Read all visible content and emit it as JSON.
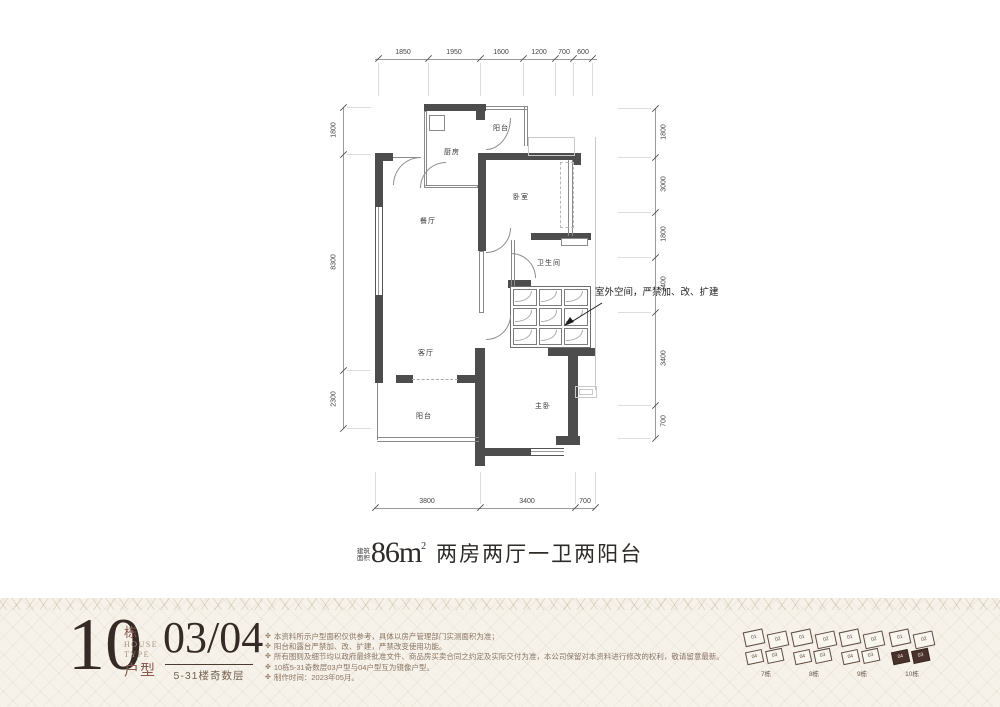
{
  "title": {
    "prefix_line1": "建筑",
    "prefix_line2": "面积",
    "area": "86m",
    "area_sup": "2",
    "desc": "两房两厅一卫两阳台"
  },
  "plan": {
    "rooms": [
      {
        "label": "厨房"
      },
      {
        "label": "阳台"
      },
      {
        "label": "卧室"
      },
      {
        "label": "餐厅"
      },
      {
        "label": "卫生间"
      },
      {
        "label": "客厅"
      },
      {
        "label": "阳台"
      },
      {
        "label": "主卧"
      }
    ],
    "annotation": "室外空间，严禁加、改、扩建",
    "dims": {
      "top": [
        "1850",
        "1950",
        "1600",
        "1200",
        "700",
        "600"
      ],
      "left": [
        "1800",
        "8300",
        "2300"
      ],
      "right": [
        "1800",
        "3000",
        "1800",
        "2400",
        "3400",
        "700"
      ],
      "bottom": [
        "3800",
        "3400",
        "700"
      ]
    }
  },
  "footer": {
    "block_number": "10",
    "block_suffix": "栋",
    "house_word": "HOUSE",
    "type_word": "TYPE",
    "huxing_word": "户型",
    "units": "03/04",
    "floors": "5-31楼奇数层",
    "note_bullet": "✤",
    "notes": [
      "本资料所示户型面积仅供参考，具体以房产管理部门实测面积为准；",
      "阳台和露台严禁加、改、扩建，严禁改变使用功能。",
      "所有图则及细节均以政府最终批准文件、商品房买卖合同之约定及实际交付为准，本公司保留对本资料进行修改的权利，敬请留意最新。",
      "10栋5-31奇数层03户型与04户型互为镜像户型。",
      "制作时间：2023年05月。"
    ],
    "keyplans": [
      {
        "label": "7栋"
      },
      {
        "label": "8栋"
      },
      {
        "label": "9栋"
      },
      {
        "label": "10栋"
      }
    ],
    "unit_numbers": [
      "01",
      "02",
      "03",
      "04"
    ]
  },
  "colors": {
    "wall": "#4d4d4d",
    "thin_line": "#8a8a8a",
    "light_line": "#c9c9c9",
    "title_text": "#2f2b28",
    "brand_dark": "#352a26",
    "brand_red": "#8a5a4e",
    "note_text": "#8b7565",
    "footer_bg": "#f6f2e9",
    "active_unit": "#4a322c"
  }
}
